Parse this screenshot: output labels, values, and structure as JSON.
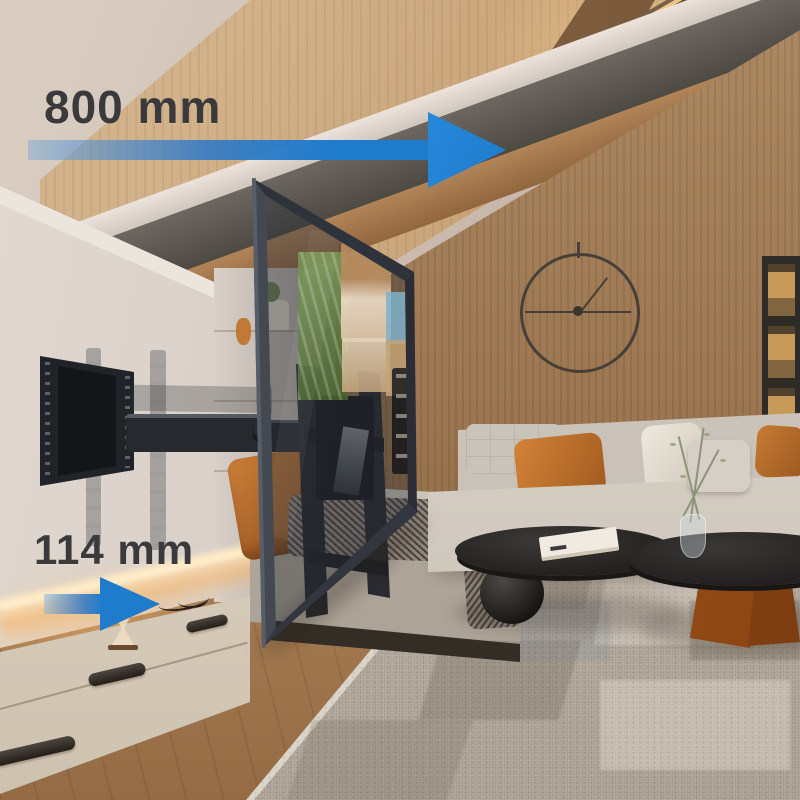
{
  "image_type": "tv-wall-mount-product-photo",
  "annotations": {
    "extension": {
      "label": "800 mm",
      "icon": "arrow-right-long-icon"
    },
    "depth": {
      "label": "114 mm",
      "icon": "arrow-right-short-icon"
    }
  },
  "colors": {
    "arrow_blue": "#1f7ccd",
    "annotation_text": "#3a3a3c",
    "mount_black": "#202328",
    "accent_pillow_orange": "#c67b34",
    "wood_wall_brown": "#9a7550"
  },
  "scene_objects": [
    "articulating-tv-wall-mount",
    "extended-television",
    "white-media-wall-niche",
    "tv-console-with-led-glow",
    "sofa-with-pillows",
    "nesting-coffee-tables",
    "minimalist-wall-clock",
    "display-cabinet",
    "area-rug",
    "attic-skylight"
  ]
}
